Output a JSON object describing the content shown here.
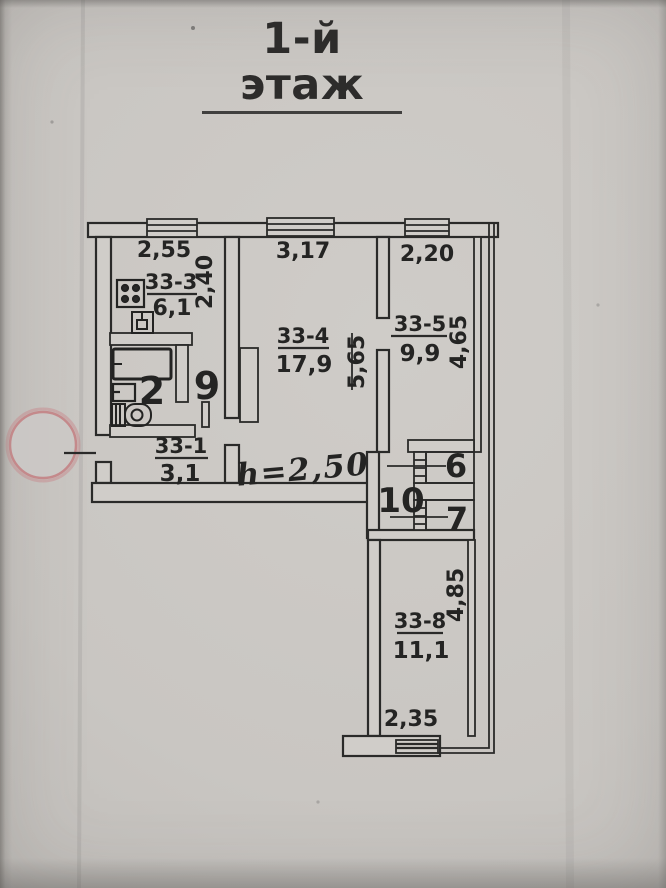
{
  "title": "1-й этаж",
  "note": {
    "text": "h=2,50"
  },
  "plan": {
    "dimensions": {
      "kitchen_width": "2,55",
      "living_width": "3,17",
      "bedroom_width": "2,20",
      "kitchen_depth": "2,40",
      "living_depth": "5,65",
      "bedroom_depth": "4,65",
      "room8_depth": "4,85",
      "room8_width": "2,35"
    },
    "rooms": {
      "kitchen": {
        "number": "33-3",
        "area": "6,1"
      },
      "living": {
        "number": "33-4",
        "area": "17,9"
      },
      "bedroom": {
        "number": "33-5",
        "area": "9,9"
      },
      "hallway": {
        "number": "33-1",
        "area": "3,1"
      },
      "room8": {
        "number": "33-8",
        "area": "11,1"
      }
    },
    "spaces": {
      "bathroom": "2",
      "inner_hall": "9",
      "closet_a": "6",
      "corridor": "10",
      "closet_b": "7"
    }
  },
  "icons": {
    "stove": "four-burner-grid",
    "kitchen_sink": "square-with-tap",
    "bathtub": "rect-outline-with-tap",
    "wash_sink": "small-square-with-tap",
    "toilet": "tank-and-bowl",
    "window": "triple-line-rect",
    "stamp": "red-ring-circle"
  },
  "colors": {
    "ink": "#4f42a5",
    "line": "#2a2a29",
    "stamp_ring": "#c4898b"
  }
}
